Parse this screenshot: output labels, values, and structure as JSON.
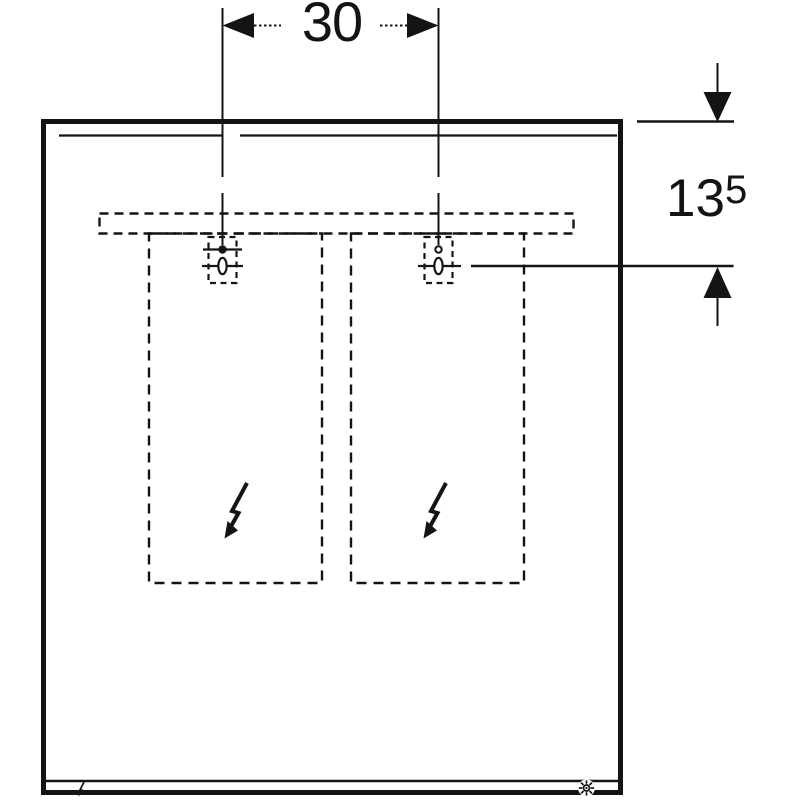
{
  "drawing": {
    "background": "#ffffff",
    "line_color": "#141414",
    "labels": {
      "width_dimension": "30",
      "height_dimension_main": "13",
      "height_dimension_sup": "5"
    },
    "icons": {
      "left_compartment": "lightning-arrow",
      "right_compartment": "lightning-arrow",
      "bottom_left": "mini-lightning",
      "bottom_right": "sun-light"
    }
  }
}
